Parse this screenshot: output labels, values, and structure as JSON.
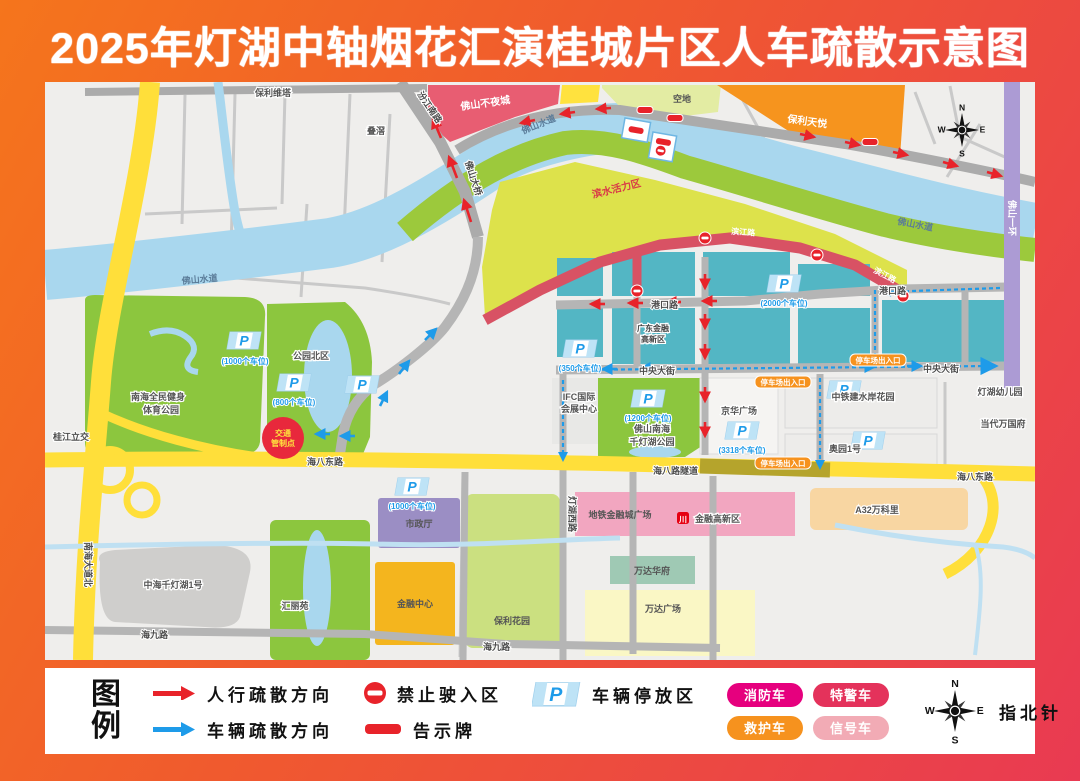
{
  "title": "2025年灯湖中轴烟花汇演桂城片区人车疏散示意图",
  "legend": {
    "title_chars": [
      "图",
      "例"
    ],
    "pedestrian": "人行疏散方向",
    "vehicle": "车辆疏散方向",
    "no_entry": "禁止驶入区",
    "notice_board": "告示牌",
    "parking_zone": "车辆停放区",
    "fire_truck": "消防车",
    "swat_truck": "特警车",
    "ambulance": "救护车",
    "signal_truck": "信号车",
    "compass_label": "指北针"
  },
  "map": {
    "parking_letter": "P",
    "compass": {
      "n": "N",
      "e": "E",
      "s": "S",
      "w": "W"
    },
    "labels": {
      "river": "佛山水道",
      "poly_vista": "保利维塔",
      "diejiao": "叠滘",
      "fs_night_city": "佛山不夜城",
      "kongdi": "空地",
      "poly_tianyue": "保利天悦",
      "waterfront_zone": "滨水活力区",
      "binjiang_rd": "滨江路",
      "gangkou_rd": "港口路",
      "zhongyang_st": "中央大街",
      "haiba_rd": "海八东路",
      "haiba_tunnel": "海八路隧道",
      "nanhai_ave": "南海大道北",
      "fs_ring": "佛山一环",
      "fs_bridge": "佛山大桥",
      "fenjiang_rd": "汾江南路",
      "guijiang_jct": "桂江立交",
      "denghuxi_rd": "灯湖西路",
      "haijiu_rd": "海九路",
      "park_north": "公园北区",
      "west_park_l1": "南海全民健身",
      "west_park_l2": "体育公园",
      "south_park_l1": "佛山南海",
      "south_park_l2": "千灯湖公园",
      "ifc_l1": "IFC国际",
      "ifc_l2": "会展中心",
      "gdfin_l1": "广东金融",
      "gdfin_l2": "高新区",
      "jinghua_plaza": "京华广场",
      "ztj_garden": "中铁建水岸花园",
      "aoyuan_no1": "奥园1号",
      "dangdai": "当代万国府",
      "denghu_kg": "灯湖幼儿园",
      "a32": "A32万科里",
      "metro_plaza": "地铁金融城广场",
      "metro_station": "金融高新区",
      "metro_icon_glyph": "川",
      "wanda_hf": "万达华府",
      "wanda_plaza": "万达广场",
      "poly_garden": "保利花园",
      "city_hall": "市政厅",
      "fin_center": "金融中心",
      "huili_yuan": "汇丽苑",
      "zhonghai_no1": "中海千灯湖1号",
      "control_l1": "交通",
      "control_l2": "管制点",
      "guide_badge": "停车场出入口"
    },
    "parking_capacities": {
      "west_park": "(1000个车位)",
      "north_park": "(800个车位)",
      "south_park": "(1200个车位)",
      "jinghua": "(3318个车位)",
      "left_block": "(350个车位)",
      "riverside": "(2000个车位)",
      "city_hall": "(1000个车位)"
    },
    "colors": {
      "frame_gradient_start": "#F5751C",
      "frame_gradient_end": "#E93A52",
      "river_blue": "#A9D7EE",
      "park_green": "#8CC63E",
      "bank_green": "#9CC93C",
      "activity_zone": "#DDE24B",
      "teal_block": "#53B6C4",
      "road_yellow": "#FFDF3A",
      "road_olive": "#B5A42C",
      "road_purple": "#AC9BD4",
      "closed_red": "#D85264",
      "arrow_red": "#E8232A",
      "arrow_blue": "#1E9BE9",
      "badge_fire": "#E6007E",
      "badge_swat": "#E4325B",
      "badge_ambulance": "#F6921E",
      "badge_signal": "#F2ABB5",
      "guide_orange": "#F6921E",
      "pink_block": "#F2A6C0"
    }
  }
}
